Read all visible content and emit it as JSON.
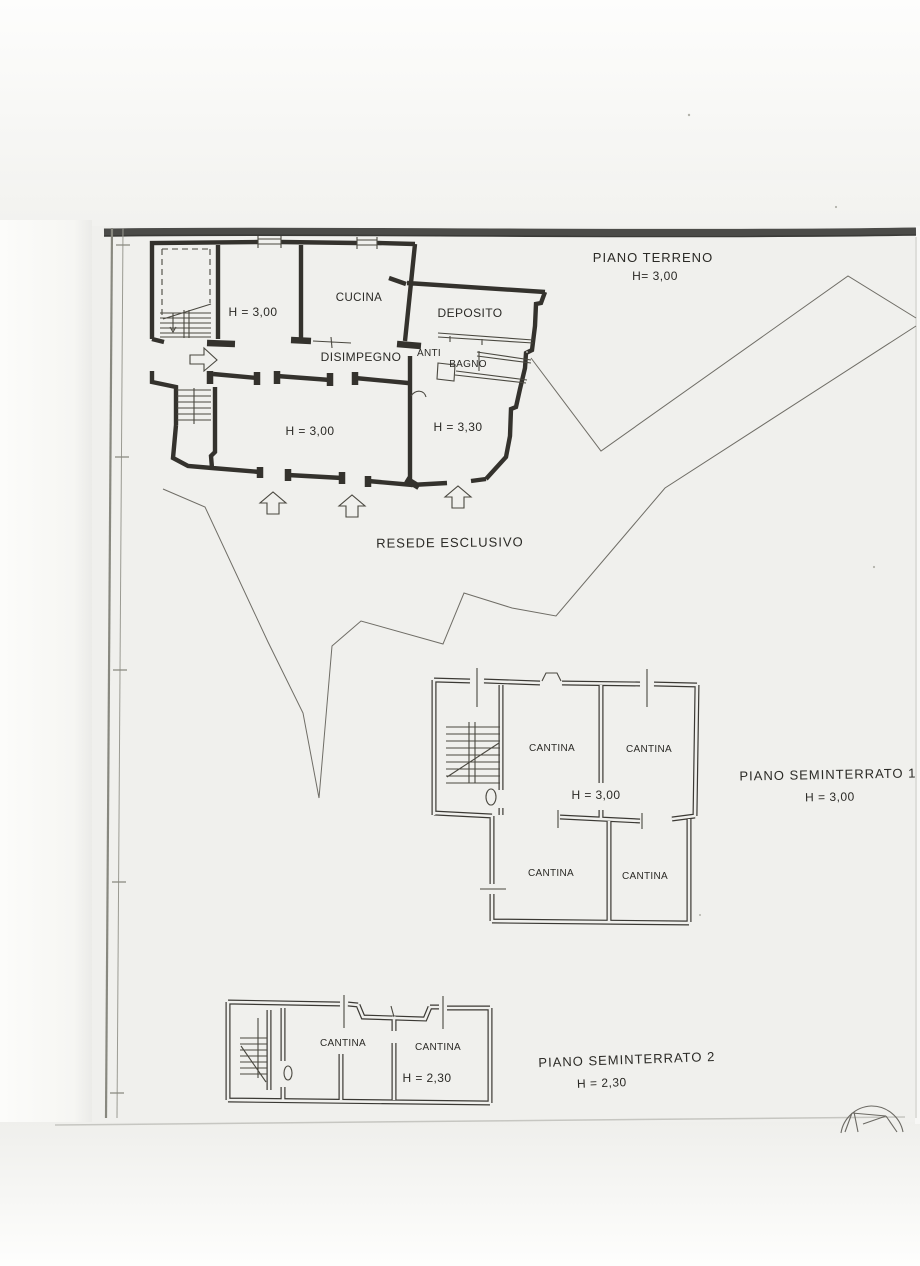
{
  "scan": {
    "paper_color": "#f0f0ed",
    "ink_color": "#34322d",
    "boundary_color": "#6f6d66"
  },
  "floor_plans": {
    "piano_terreno": {
      "title": "PIANO TERRENO",
      "height_label": "H= 3,00",
      "rooms": {
        "upper_left_height": "H = 3,00",
        "cucina": "CUCINA",
        "deposito": "DEPOSITO",
        "disimpegno": "DISIMPEGNO",
        "anti": "ANTI",
        "bagno": "BAGNO",
        "lower_height": "H = 3,00",
        "right_height": "H = 3,30"
      }
    },
    "piano_seminterrato_1": {
      "title": "PIANO SEMINTERRATO 1",
      "height_label": "H = 3,00",
      "rooms": {
        "cantina_top_left": "CANTINA",
        "cantina_top_right": "CANTINA",
        "center_height": "H = 3,00",
        "cantina_bottom_left": "CANTINA",
        "cantina_bottom_right": "CANTINA"
      }
    },
    "piano_seminterrato_2": {
      "title": "PIANO SEMINTERRATO 2",
      "height_label": "H = 2,30",
      "rooms": {
        "cantina_left": "CANTINA",
        "cantina_right": "CANTINA",
        "center_height": "H = 2,30"
      }
    }
  },
  "site": {
    "courtyard_label": "RESEDE ESCLUSIVO"
  }
}
